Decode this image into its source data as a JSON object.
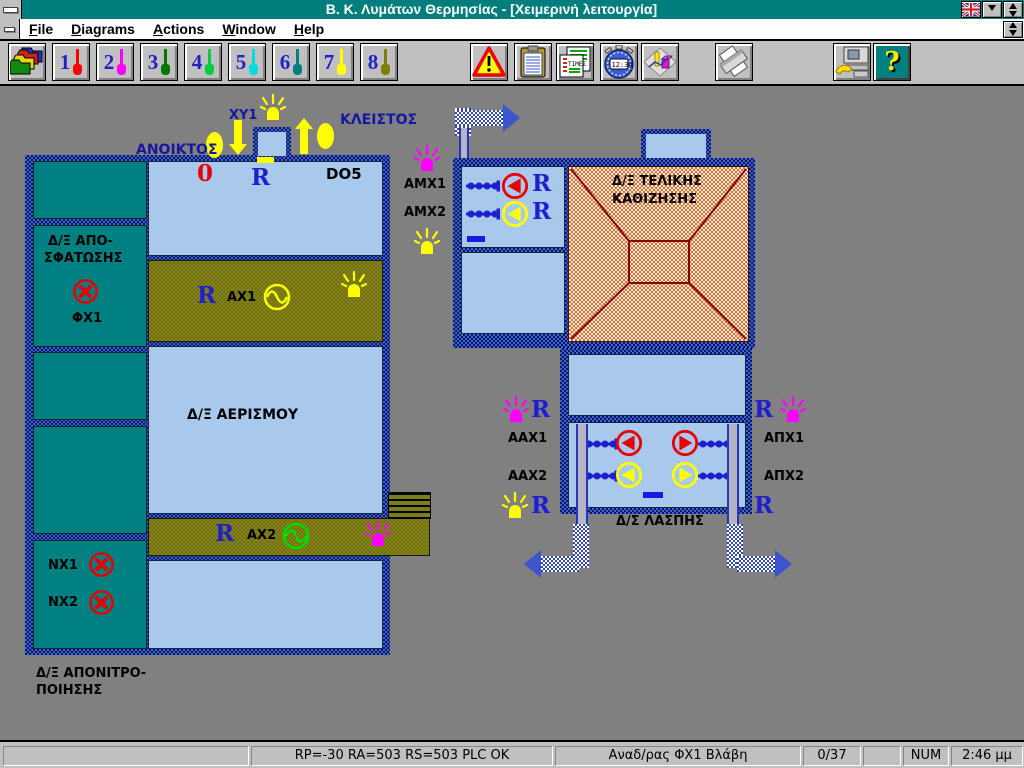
{
  "window": {
    "title": "Β. Κ. Λυμάτων Θερμησίας - [Χειμερινή λειτουργία]",
    "titlebar_color": "#007d7d"
  },
  "menu": {
    "items": [
      {
        "label": "File"
      },
      {
        "label": "Diagrams"
      },
      {
        "label": "Actions"
      },
      {
        "label": "Window"
      },
      {
        "label": "Help"
      }
    ]
  },
  "toolbar": {
    "diagram_buttons": [
      {
        "num": "1",
        "color": "#ff0000"
      },
      {
        "num": "2",
        "color": "#ff00ff"
      },
      {
        "num": "3",
        "color": "#007700"
      },
      {
        "num": "4",
        "color": "#00cc44"
      },
      {
        "num": "5",
        "color": "#00dddd"
      },
      {
        "num": "6",
        "color": "#008080"
      },
      {
        "num": "7",
        "color": "#ffff00"
      },
      {
        "num": "8",
        "color": "#808000"
      }
    ],
    "times_label": "ΤΙΜΕΣ",
    "stopwatch_time": "12:34",
    "help_mark": "?"
  },
  "diagram": {
    "r_label": "R",
    "valve": {
      "tag": "ΧΥ1",
      "open": "ΑΝΟΙΚΤΟΣ",
      "closed": "ΚΛΕΙΣΤΟΣ"
    },
    "do_tank": {
      "digit": "0",
      "label": "DO5"
    },
    "left_plant": {
      "desludge1": "Δ/Ξ ΑΠΟ-",
      "desludge2": "ΣΦΑΤΩΣΗΣ",
      "fx1": "ΦΧ1",
      "aeration": "Δ/Ξ ΑΕΡΙΣΜΟΥ",
      "ax1": "ΑΧ1",
      "ax2": "ΑΧ2",
      "nx1": "ΝΧ1",
      "nx2": "ΝΧ2",
      "denit1": "Δ/Ξ ΑΠΟΝΙΤΡΟ-",
      "denit2": "ΠΟΙΗΣΗΣ"
    },
    "right_plant": {
      "settling1": "Δ/Ξ ΤΕΛΙΚΗΣ",
      "settling2": "ΚΑΘΙΖΗΣΗΣ",
      "amx1": "ΑΜΧ1",
      "amx2": "ΑΜΧ2",
      "aax1": "ΑΑΧ1",
      "aax2": "ΑΑΧ2",
      "apx1": "ΑΠΧ1",
      "apx2": "ΑΠΧ2",
      "sludge": "Δ/Σ ΛΑΣΠΗΣ"
    },
    "colors": {
      "tank_teal": "#008080",
      "tank_blue": "#a8c8ec",
      "olive_channel": "#7d7d18",
      "border_navy": "#1a3a8c",
      "settling_fill": "#e8b080",
      "lamp_yellow": "#ffff00",
      "lamp_magenta": "#ff00ff",
      "pump_red": "#ff0000",
      "pump_yellow": "#ffff00",
      "wave_yellow": "#ffff00",
      "wave_green": "#00dd00",
      "label_navy": "#16169e",
      "r_blue": "#1f1fd0",
      "alarm_red": "#e80000"
    }
  },
  "statusbar": {
    "plc": "RP=-30 RA=503  RS=503  PLC  OK",
    "alarm": "Αναδ/ρας ΦΧ1 Βλάβη",
    "counter": "0/37",
    "num": "NUM",
    "time": "2:46 μμ"
  }
}
